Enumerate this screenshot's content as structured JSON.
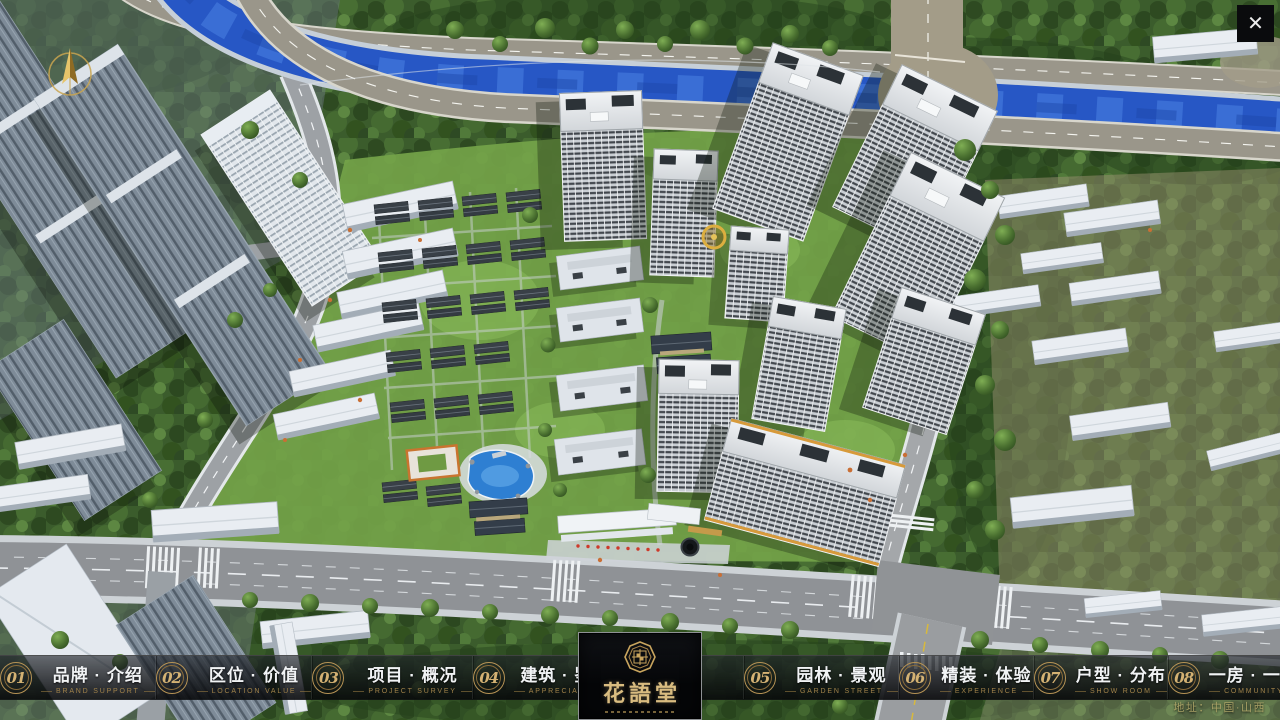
{
  "app": {
    "type": "real-estate sales presentation fullscreen UI",
    "icons": {
      "close": "✕"
    }
  },
  "nav": {
    "items": [
      {
        "num": "01",
        "label": "品牌 · 介绍",
        "sub": "BRAND SUPPORT"
      },
      {
        "num": "02",
        "label": "区位 · 价值",
        "sub": "LOCATION VALUE"
      },
      {
        "num": "03",
        "label": "项目 · 概况",
        "sub": "PROJECT SURVEY"
      },
      {
        "num": "04",
        "label": "建筑 · 鉴赏",
        "sub": "APPRECIATION"
      },
      {
        "num": "05",
        "label": "园林 · 景观",
        "sub": "GARDEN STREET"
      },
      {
        "num": "06",
        "label": "精装 · 体验",
        "sub": "EXPERIENCE"
      },
      {
        "num": "07",
        "label": "户型 · 分布",
        "sub": "SHOW ROOM"
      },
      {
        "num": "08",
        "label": "一房 · 一景",
        "sub": "COMMUNITY"
      }
    ]
  },
  "logo": {
    "name": "花語堂"
  },
  "footer": {
    "address": "地址：中国·山西"
  },
  "colors": {
    "accent_gold": "#c5a05c",
    "nav_chinese": "#f1f3f5",
    "nav_english": "#a0824a",
    "bar_background": "rgba(7,8,10,0.9)",
    "river_blue": "#2757c5",
    "lawn_green": "#74a349"
  }
}
